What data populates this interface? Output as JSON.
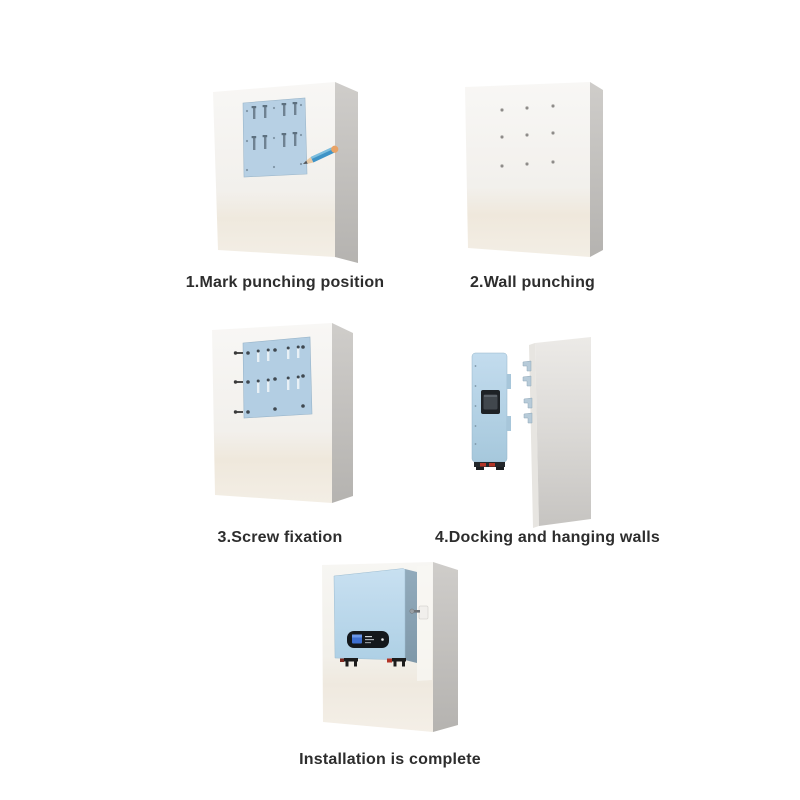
{
  "title": "Wall-mount installation guide",
  "steps": [
    {
      "id": 1,
      "label": "1.Mark punching position"
    },
    {
      "id": 2,
      "label": "2.Wall punching"
    },
    {
      "id": 3,
      "label": "3.Screw fixation"
    },
    {
      "id": 4,
      "label": "4.Docking and hanging walls"
    },
    {
      "id": 5,
      "label": "Installation is complete"
    }
  ],
  "colors": {
    "background": "#ffffff",
    "wall_face_light": "#f7f6f4",
    "wall_face_warm": "#f1ebe0",
    "wall_side_gray": "#c2c0bd",
    "template_blue": "#b7d0e4",
    "device_blue_front": "#c3dcee",
    "device_blue_side": "#8fa6b6",
    "pencil_blue": "#3e93c6",
    "pencil_eraser_tan": "#e9a366",
    "connector_red": "#b33527",
    "display_black": "#14181c",
    "display_screen_blue": "#3e6fd0",
    "caption_text": "#2d2d2d"
  }
}
